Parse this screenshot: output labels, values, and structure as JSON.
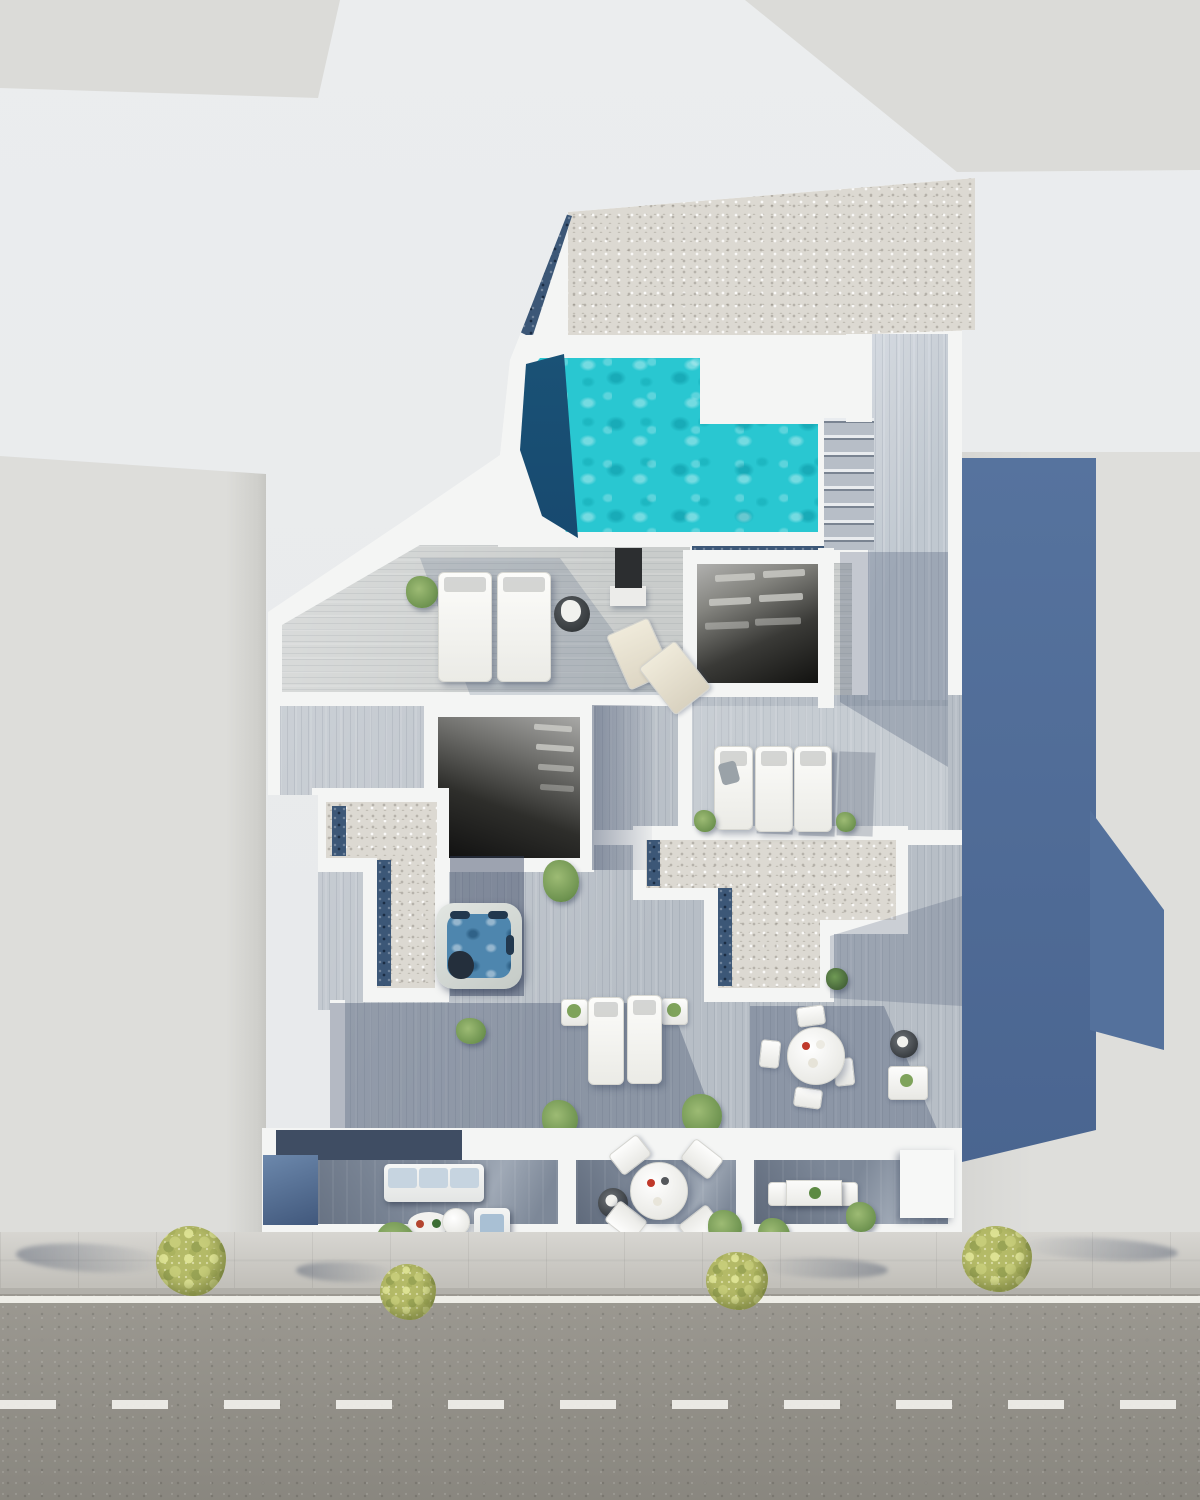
{
  "scene": {
    "type": "3d-aerial-architectural-render",
    "subject": "top-down daylight render of a residential building rooftop and terraces between neighboring buildings, street with sidewalk in front",
    "camera": "orthographic top-down, slight oblique",
    "visible_text": ""
  },
  "colors": {
    "background": "#ebedee",
    "neighbor_roof": "#dbdbd8",
    "building_white": "#f4f5f4",
    "deck_light": "#c9cccb",
    "deck_mid": "#b7bec6",
    "deck_shadow": "#7d8898",
    "gravel": "#dcd9d2",
    "gravel_dark": "#3c5777",
    "pool_turquoise": "#29c7d1",
    "pool_deep": "#17496f",
    "jacuzzi_water": "#4e86ae",
    "atrium_dark": "#151513",
    "shadow_blue": "#56739e",
    "glass_blue": "#6c88ac",
    "street": "#95928a",
    "sidewalk": "#cac8c2",
    "road_marking": "#f2f1ec",
    "tree_foliage": "#b4ba67",
    "plant_green_light": "#9dbb74",
    "furniture_white": "#f2f2f0",
    "cushion_blue": "#c6d4e0"
  },
  "inventory": {
    "swimming_pools": 1,
    "jacuzzis": 1,
    "stairwell_openings": 2,
    "staircases": 1,
    "gravel_roof_sections": 3,
    "sun_loungers": 7,
    "folding_deck_chairs": 2,
    "round_dining_sets": 2,
    "rectangular_dining_sets": 1,
    "sofas": 1,
    "armchairs": 1,
    "planters_and_bushes": 14,
    "street_trees": 4,
    "neighbor_buildings": 4
  },
  "street": {
    "edge_line": "solid white line along curb",
    "center_line": "dashed white lane marking",
    "surface": "asphalt"
  }
}
